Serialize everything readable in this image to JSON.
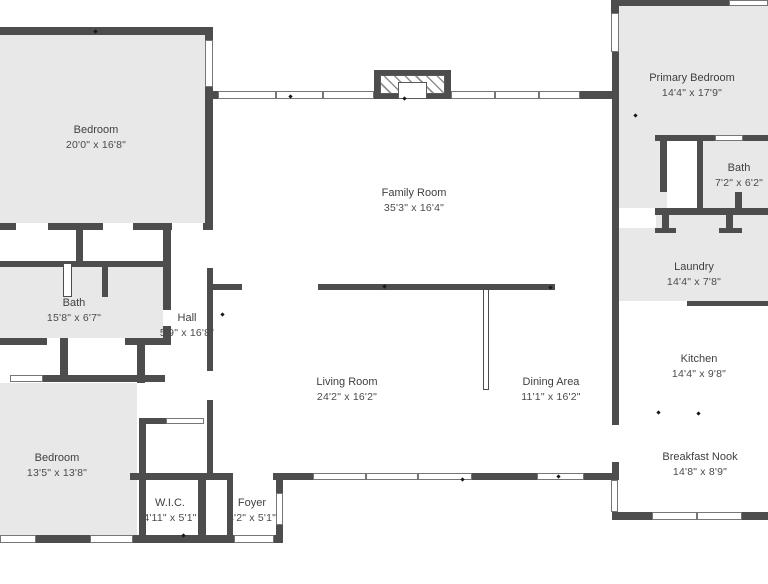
{
  "plan": {
    "colors": {
      "wall": "#4d4d4d",
      "room": "#e8e8e8",
      "winb": "#767676",
      "text": "#3f3f3f"
    },
    "rooms": [
      {
        "id": "bedroom-top-left",
        "name": "Bedroom",
        "dims": "20'0\" x 16'8\""
      },
      {
        "id": "family-room",
        "name": "Family Room",
        "dims": "35'3\" x 16'4\""
      },
      {
        "id": "primary-bedroom",
        "name": "Primary Bedroom",
        "dims": "14'4\" x 17'9\""
      },
      {
        "id": "bath-primary",
        "name": "Bath",
        "dims": "7'2\" x 6'2\""
      },
      {
        "id": "laundry",
        "name": "Laundry",
        "dims": "14'4\" x 7'8\""
      },
      {
        "id": "kitchen",
        "name": "Kitchen",
        "dims": "14'4\" x 9'8\""
      },
      {
        "id": "breakfast-nook",
        "name": "Breakfast Nook",
        "dims": "14'8\" x 8'9\""
      },
      {
        "id": "bath-left",
        "name": "Bath",
        "dims": "15'8\" x 6'7\""
      },
      {
        "id": "hall",
        "name": "Hall",
        "dims": "5'9\" x 16'8\""
      },
      {
        "id": "living-room",
        "name": "Living Room",
        "dims": "24'2\" x 16'2\""
      },
      {
        "id": "dining-area",
        "name": "Dining Area",
        "dims": "11'1\" x 16'2\""
      },
      {
        "id": "bedroom-bottom-left",
        "name": "Bedroom",
        "dims": "13'5\" x 13'8\""
      },
      {
        "id": "wic",
        "name": "W.I.C.",
        "dims": "4'11\" x 5'1\""
      },
      {
        "id": "foyer",
        "name": "Foyer",
        "dims": "4'2\" x 5'1\""
      }
    ]
  }
}
